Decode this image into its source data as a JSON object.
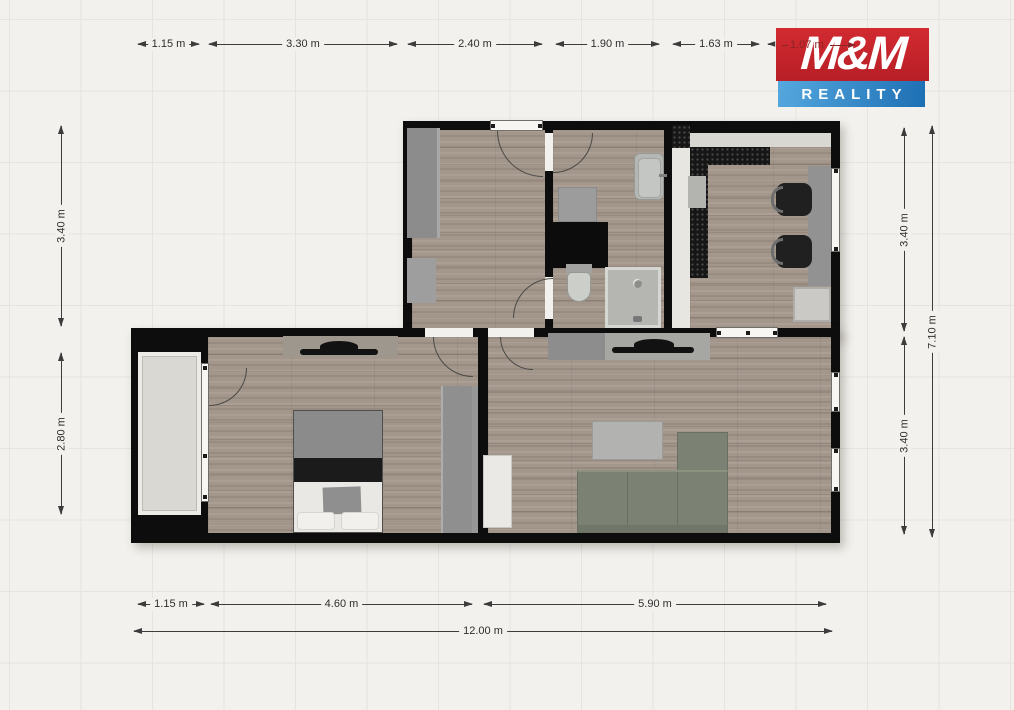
{
  "meta": {
    "description": "Real-estate floor plan of an apartment with dimension chains",
    "units": "m"
  },
  "logo": {
    "line1": "M&M",
    "line2": "REALITY",
    "overlap_dim": "1.07 m",
    "red": "#c4242b",
    "blue": "#2e86c8"
  },
  "dimensions": {
    "top": [
      "1.15 m",
      "3.30 m",
      "2.40 m",
      "1.90 m",
      "1.63 m",
      "1.07 m"
    ],
    "bottom": [
      "1.15 m",
      "4.60 m",
      "5.90 m"
    ],
    "bottom_total": "12.00 m",
    "left": [
      "3.40 m",
      "2.80 m"
    ],
    "right": [
      "3.40 m",
      "3.40 m"
    ],
    "right_total": "7.10 m"
  },
  "colors": {
    "wall": "#0d0d0d",
    "wood_floor": "#a3968b",
    "balcony_floor": "#d9d8d2",
    "sofa": "#7b8173",
    "background": "#f2f1ed",
    "dimension_text": "#2e2e2e"
  }
}
